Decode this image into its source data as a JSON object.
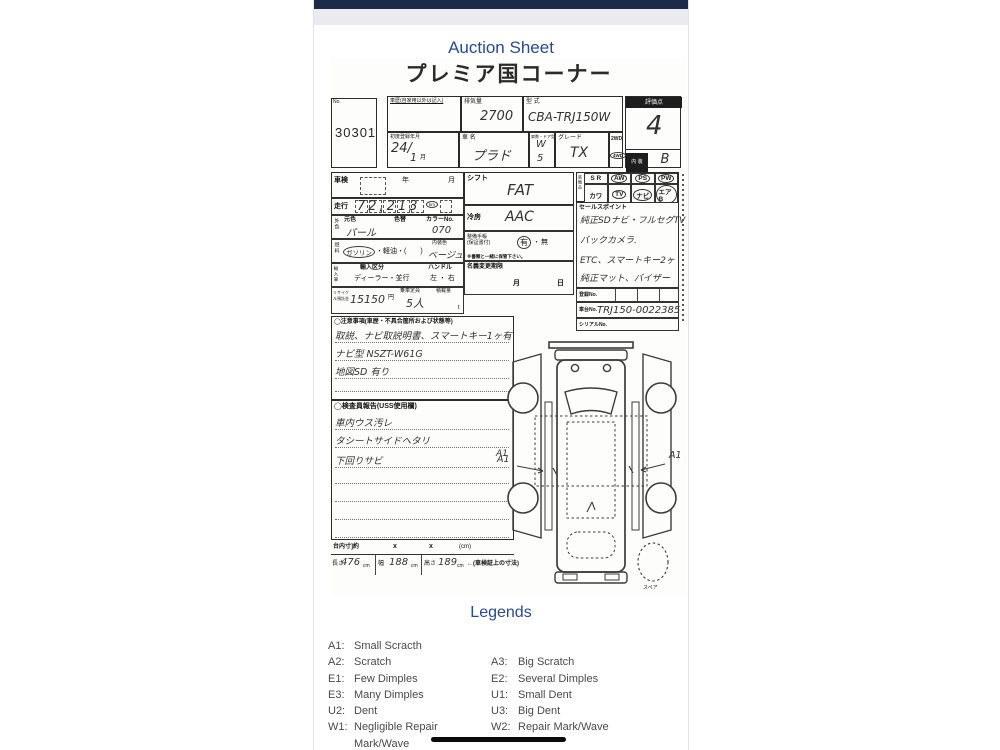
{
  "page": {
    "title": "Auction Sheet"
  },
  "sheet": {
    "header": "プレミア国コーナー",
    "no_label": "No.",
    "auction_no": "30301",
    "top": {
      "history_label": "車歴(自家用以外は記入)",
      "disp_label": "排気量",
      "disp_value": "2700",
      "model_label": "型 式",
      "model_value": "CBA-TRJ150W",
      "score_label": "評価点",
      "score_value": "4",
      "interior_label": "内 装",
      "interior_value": "B",
      "firstreg_label": "初度登録年月",
      "firstreg_value": "24/",
      "firstreg_month": "1",
      "firstreg_month_label": "月",
      "name_label": "車 名",
      "name_value": "プラド",
      "door_label": "扉数・ドア型",
      "door_w": "W",
      "door_n": "5",
      "grade_label": "グレード",
      "grade_value": "TX",
      "wd2": "2WD",
      "wd4": "4WD"
    },
    "mid": {
      "shaken_label": "車検",
      "year_label": "年",
      "month_label": "月",
      "odo_label": "走行",
      "odo_value": "72,213",
      "odo_unit": "km",
      "color_group_label": "外色",
      "basecolor_label": "元色",
      "basecolor_value": "パール",
      "colorchange_label": "色替",
      "colorno_label": "カラーNo.",
      "colorno_value": "070",
      "fuel_group_label": "燃料",
      "fuel_gas": "ガソリン",
      "fuel_rest": "・軽油・(　　)",
      "intcolor_label": "内装色",
      "intcolor_value": "ベージュ",
      "import_group_label": "輸入車",
      "import_label": "輸入区分",
      "import_options": "ディーラー・並行",
      "handle_label": "ハンドル",
      "handle_options": "左 ・ 右",
      "recycle_label": "リサイクル預託金",
      "recycle_value": "15150",
      "yen_label": "円",
      "capacity_label": "乗車定員",
      "capacity_value": "5人",
      "load_label": "積載量",
      "ton_label": "t",
      "shift_label": "シフト",
      "shift_value": "FAT",
      "ac_label": "冷房",
      "ac_value": "AAC",
      "warranty_label": "整備手帳",
      "warranty_sub": "(保証書付)",
      "warranty_yes": "有",
      "warranty_dot": "・",
      "warranty_no": "無",
      "warranty_note": "※書類と一緒に保管下さい。",
      "transfer_label": "名義変更期限",
      "transfer_month": "月",
      "transfer_day": "日"
    },
    "equip": {
      "group_label": "装備品",
      "cells": [
        "S R",
        "AW",
        "PS",
        "PW",
        "カワ",
        "TV",
        "ナビ",
        "エアB"
      ]
    },
    "sales": {
      "label": "セールスポイント",
      "lines": [
        "純正SDナビ・フルセグTV",
        "バックカメラ.",
        "ETC、スマートキー2ヶ",
        "純正マット、バイザー"
      ]
    },
    "reg": {
      "regno_label": "登録No.",
      "chassis_label": "車台No.",
      "chassis_value": "TRJ150-0022385",
      "serial_label": "シリアルNo."
    },
    "notes": {
      "label": "◯注意事項(車歴・不具合箇所および状態等)",
      "lines": [
        "取説、ナビ取説明書、スマートキー1ヶ有",
        "ナビ型 NSZT-W61G",
        "地図SD 有り"
      ]
    },
    "inspector": {
      "label": "◯検査員報告(USS使用欄)",
      "lines": [
        "車内ウス汚レ",
        "タシートサイドヘタリ",
        "下回りサビ"
      ],
      "mark": "A1"
    },
    "dims": {
      "inner_label": "台内寸]約",
      "x1": "x",
      "x2": "x",
      "cm_label": "(cm)",
      "len_label": "長さ",
      "len_value": "476",
      "len_unit": "cm",
      "wid_label": "幅",
      "wid_value": "188",
      "wid_unit": "cm",
      "hgt_label": "高さ",
      "hgt_value": "189",
      "hgt_unit": "cm",
      "note": "←(車検証上の寸法)"
    },
    "diagram": {
      "left_mark": "A1",
      "right_mark": "A1",
      "spare_label": "スペア"
    }
  },
  "legends": {
    "title": "Legends",
    "left": [
      {
        "code": "A1:",
        "label": "Small Scracth"
      },
      {
        "code": "A2:",
        "label": "Scratch"
      },
      {
        "code": "E1:",
        "label": "Few Dimples"
      },
      {
        "code": "E3:",
        "label": "Many Dimples"
      },
      {
        "code": "U2:",
        "label": "Dent"
      },
      {
        "code": "W1:",
        "label": "Negligible Repair Mark/Wave"
      }
    ],
    "right": [
      {
        "code": "A3:",
        "label": "Big Scratch"
      },
      {
        "code": "E2:",
        "label": "Several Dimples"
      },
      {
        "code": "U1:",
        "label": "Small Dent"
      },
      {
        "code": "U3:",
        "label": "Big Dent"
      },
      {
        "code": "W2:",
        "label": "Repair Mark/Wave"
      }
    ]
  }
}
